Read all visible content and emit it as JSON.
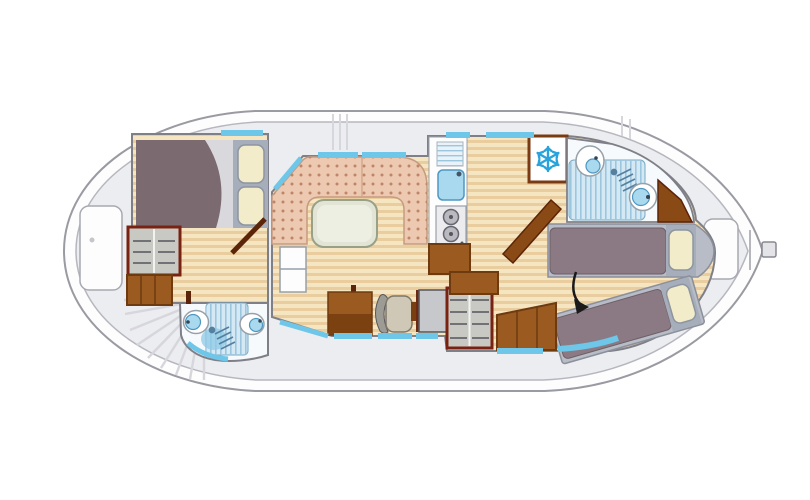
{
  "figure": {
    "kind": "houseboat-floor-plan",
    "orientation": "bow-left-stern-right",
    "rooms": [
      {
        "id": "bow-cabin",
        "features": [
          "double-bed",
          "wardrobe",
          "door"
        ]
      },
      {
        "id": "bow-bathroom",
        "features": [
          "toilet",
          "shower",
          "sink"
        ]
      },
      {
        "id": "saloon",
        "features": [
          "u-shaped-dinette",
          "table",
          "storage-steps"
        ]
      },
      {
        "id": "helm",
        "features": [
          "bench",
          "helm-chair",
          "console",
          "wardrobe"
        ]
      },
      {
        "id": "galley",
        "features": [
          "drainer",
          "sink",
          "stove",
          "cabinet",
          "fridge"
        ]
      },
      {
        "id": "aft-bathroom",
        "features": [
          "sink",
          "shower",
          "toilet"
        ]
      },
      {
        "id": "aft-cabin",
        "features": [
          "single-bed",
          "single-bed-angled",
          "steps",
          "door"
        ]
      }
    ],
    "icons": [
      "snowflake-icon",
      "shower-head-icon",
      "direction-arrow-icon",
      "stairs-fan-icon"
    ]
  },
  "colors": {
    "hull-line": "#9a9aa2",
    "gunwale-line": "#b6b6be",
    "deck": "#ecedf0",
    "deck-line": "#d6d6dc",
    "wall": "#7f7f88",
    "white": "#fdfdfe",
    "floor-a": "#f5e5c0",
    "floor-b": "#e9cd9e",
    "cushion": "#eec9b1",
    "cushion-dot": "#bd8668",
    "cushion-edge": "#c59c80",
    "table": "#e2e5d5",
    "table-edge": "#99a088",
    "table-inner": "#edefe2",
    "wood": "#9a5a20",
    "wood-dark": "#6e3a10",
    "wood-deep": "#5c2408",
    "frame-red": "#7a2212",
    "shelf": "#c9c9c3",
    "shelf-line": "#55565c",
    "blanket": "#7b6b70",
    "fold": "#d9d9dd",
    "mattress": "#8b7a83",
    "mattress-edge": "#6d5e66",
    "bed-base": "#b7bcc6",
    "bed-base-edge": "#8a8f9a",
    "pillow": "#f2ecca",
    "pillow-edge": "#8e959f",
    "pillow-frame": "#a6adbb",
    "window": "#6ec6e8",
    "fix-blue": "#a9d9ef",
    "fix-edge": "#4f97c0",
    "fix-gray": "#98a0a8",
    "tile": "#d4e9f4",
    "tile-line": "#9cc6dd",
    "tile-edge": "#74a8c4",
    "bath-white": "#f7fafc",
    "metal": "#c6c8cc",
    "metal-edge": "#55565c",
    "steel": "#ececee",
    "burner": "#b9b9bf",
    "icon-blue": "#29a3db",
    "ink": "#1a1a1a"
  }
}
